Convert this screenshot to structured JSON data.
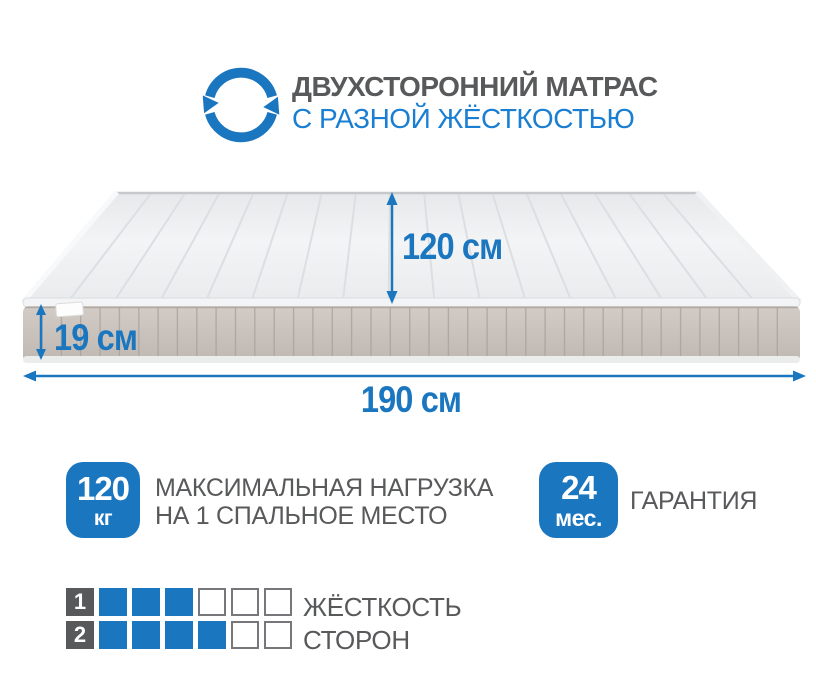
{
  "colors": {
    "blue": "#1b76c0",
    "subtitle_blue": "#1a7fd2",
    "text_gray": "#58595b",
    "mattress_band": "#c9c2bc",
    "mattress_top": "#eef0f2"
  },
  "header": {
    "icon": "rotate-arrows-icon",
    "title": "ДВУХСТОРОННИЙ МАТРАС",
    "subtitle": "С РАЗНОЙ ЖЁСТКОСТЬЮ"
  },
  "diagram": {
    "width_label": "120 см",
    "height_label": "19 см",
    "length_label": "190 см"
  },
  "badges": [
    {
      "value": "120",
      "unit": "кг",
      "lines": [
        "МАКСИМАЛЬНАЯ НАГРУЗКА",
        "НА 1 СПАЛЬНОЕ МЕСТО"
      ]
    },
    {
      "value": "24",
      "unit": "мес.",
      "lines": [
        "ГАРАНТИЯ"
      ]
    }
  ],
  "firmness": {
    "rows": [
      {
        "label": "1",
        "filled": 3,
        "total": 6
      },
      {
        "label": "2",
        "filled": 4,
        "total": 6
      }
    ],
    "captions": [
      "ЖЁСТКОСТЬ",
      "СТОРОН"
    ]
  }
}
